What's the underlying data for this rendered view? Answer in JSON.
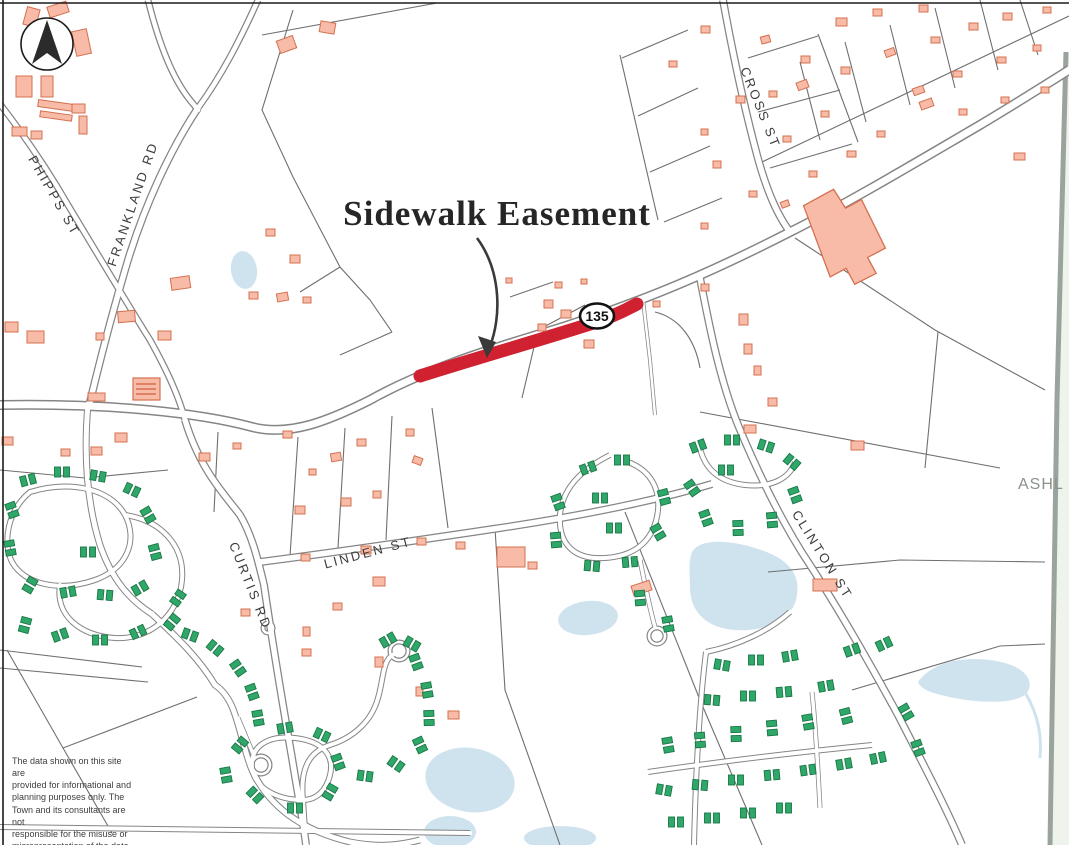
{
  "map": {
    "title": "Sidewalk Easement",
    "route_shield": "135",
    "adjacent_town_label": "ASHL",
    "streets": {
      "frankland": "FRANKLAND RD",
      "phipps": "PHIPPS ST",
      "cross": "CROSS ST",
      "curtis": "CURTIS RD",
      "linden": "LINDEN ST",
      "clinton": "CLINTON ST"
    },
    "disclaimer_lines": [
      "The data shown on this site are",
      "provided for informational and",
      "planning purposes only.  The",
      "Town and its consultants are not",
      "responsible for the misuse or",
      "misrepresentation of the data."
    ],
    "colors": {
      "easement_red": "#cf2130",
      "building_fill": "#f8bba7",
      "building_outline": "#d4704f",
      "condo_green": "#2fa768",
      "condo_outline": "#1a7747",
      "water_blue": "#cfe3ef",
      "road_casing": "#858585"
    }
  }
}
